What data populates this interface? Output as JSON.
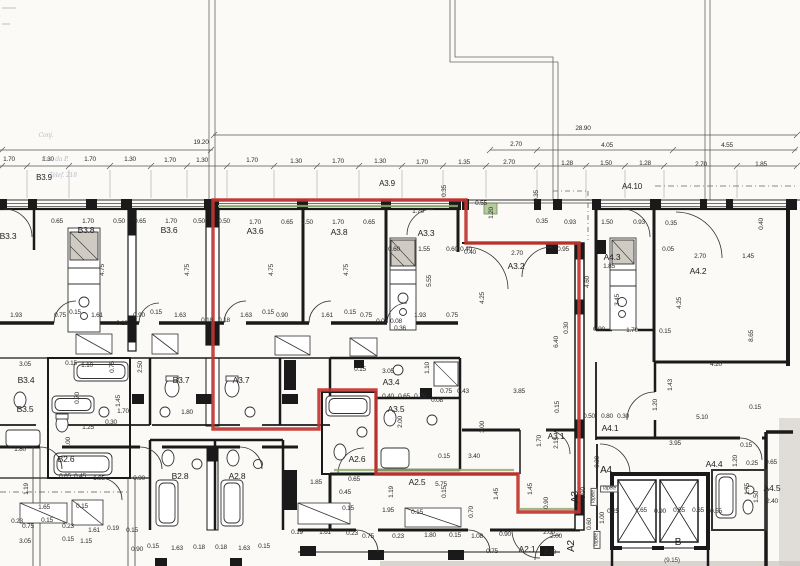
{
  "drawing": {
    "type": "apartment-floor-plan-scan",
    "highlighted_unit": "A3",
    "colors": {
      "outline_red": "#c23530",
      "outline_green": "#8fae6e",
      "wall": "#1a1a1a",
      "dim_text": "#2e2c2a",
      "paper": "#fbfaf7"
    }
  },
  "red_outline": {
    "points": "213,200 466,200 466,243 579,243 579,512 518,512 518,474 376,474 376,390 319,390 319,429 213,429"
  },
  "annotations": [
    {
      "t": "28.90",
      "x": 583,
      "y": 129
    },
    {
      "t": "19.20",
      "x": 201,
      "y": 143
    },
    {
      "t": "2.70",
      "x": 516,
      "y": 145
    },
    {
      "t": "4.05",
      "x": 607,
      "y": 146
    },
    {
      "t": "4.55",
      "x": 727,
      "y": 146
    },
    {
      "t": "1.70",
      "x": 9,
      "y": 160
    },
    {
      "t": "1.30",
      "x": 48,
      "y": 160
    },
    {
      "t": "1.70",
      "x": 90,
      "y": 160
    },
    {
      "t": "1.30",
      "x": 130,
      "y": 160
    },
    {
      "t": "1.70",
      "x": 170,
      "y": 161
    },
    {
      "t": "1.30",
      "x": 202,
      "y": 161
    },
    {
      "t": "1.70",
      "x": 252,
      "y": 161
    },
    {
      "t": "1.30",
      "x": 296,
      "y": 162
    },
    {
      "t": "1.70",
      "x": 338,
      "y": 162
    },
    {
      "t": "1.30",
      "x": 380,
      "y": 162
    },
    {
      "t": "1.70",
      "x": 422,
      "y": 163
    },
    {
      "t": "1.35",
      "x": 464,
      "y": 163
    },
    {
      "t": "2.70",
      "x": 509,
      "y": 163
    },
    {
      "t": "1.28",
      "x": 567,
      "y": 164
    },
    {
      "t": "1.50",
      "x": 606,
      "y": 164
    },
    {
      "t": "1.28",
      "x": 645,
      "y": 164
    },
    {
      "t": "2.70",
      "x": 701,
      "y": 165
    },
    {
      "t": "1.85",
      "x": 761,
      "y": 165
    },
    {
      "t": "B3.9",
      "x": 44,
      "y": 178,
      "k": "head"
    },
    {
      "t": "A3.9",
      "x": 387,
      "y": 184,
      "k": "head"
    },
    {
      "t": "A4.10",
      "x": 632,
      "y": 187,
      "k": "head"
    },
    {
      "t": "0.65",
      "x": 57,
      "y": 222
    },
    {
      "t": "1.70",
      "x": 88,
      "y": 222
    },
    {
      "t": "0.50",
      "x": 119,
      "y": 222
    },
    {
      "t": "0.65",
      "x": 140,
      "y": 222
    },
    {
      "t": "1.70",
      "x": 171,
      "y": 222
    },
    {
      "t": "0.50",
      "x": 199,
      "y": 222
    },
    {
      "t": "0.50",
      "x": 224,
      "y": 222
    },
    {
      "t": "1.70",
      "x": 255,
      "y": 223
    },
    {
      "t": "0.65",
      "x": 287,
      "y": 223
    },
    {
      "t": "0.50",
      "x": 307,
      "y": 223
    },
    {
      "t": "1.70",
      "x": 338,
      "y": 223
    },
    {
      "t": "0.65",
      "x": 369,
      "y": 223
    },
    {
      "t": "1.70",
      "x": 418,
      "y": 212
    },
    {
      "t": "0.35",
      "x": 445,
      "y": 191,
      "r": 1
    },
    {
      "t": "0.55",
      "x": 481,
      "y": 204
    },
    {
      "t": "1.20",
      "x": 492,
      "y": 213,
      "r": 1
    },
    {
      "t": "0.35",
      "x": 537,
      "y": 196,
      "r": 1
    },
    {
      "t": "0.35",
      "x": 542,
      "y": 222
    },
    {
      "t": "0.93",
      "x": 570,
      "y": 223
    },
    {
      "t": "1.50",
      "x": 607,
      "y": 223
    },
    {
      "t": "0.93",
      "x": 639,
      "y": 223
    },
    {
      "t": "0.35",
      "x": 671,
      "y": 224
    },
    {
      "t": "0.40",
      "x": 762,
      "y": 224,
      "r": 1
    },
    {
      "t": "B3.3",
      "x": 8,
      "y": 236,
      "k": "room"
    },
    {
      "t": "B3.8",
      "x": 86,
      "y": 230,
      "k": "room"
    },
    {
      "t": "B3.6",
      "x": 169,
      "y": 230,
      "k": "room"
    },
    {
      "t": "A3.6",
      "x": 255,
      "y": 231,
      "k": "room"
    },
    {
      "t": "A3.8",
      "x": 339,
      "y": 232,
      "k": "room"
    },
    {
      "t": "A3.3",
      "x": 426,
      "y": 233,
      "k": "room"
    },
    {
      "t": "A3.2",
      "x": 516,
      "y": 266,
      "k": "room"
    },
    {
      "t": "A4.3",
      "x": 612,
      "y": 257,
      "k": "room"
    },
    {
      "t": "A4.2",
      "x": 698,
      "y": 271,
      "k": "room"
    },
    {
      "t": "0.60",
      "x": 394,
      "y": 250
    },
    {
      "t": "1.55",
      "x": 424,
      "y": 250
    },
    {
      "t": "0.60",
      "x": 452,
      "y": 250
    },
    {
      "t": "0.40",
      "x": 470,
      "y": 253
    },
    {
      "t": "4.75",
      "x": 103,
      "y": 270,
      "r": 1
    },
    {
      "t": "4.75",
      "x": 188,
      "y": 270,
      "r": 1
    },
    {
      "t": "4.75",
      "x": 272,
      "y": 270,
      "r": 1
    },
    {
      "t": "4.75",
      "x": 347,
      "y": 270,
      "r": 1
    },
    {
      "t": "5.55",
      "x": 430,
      "y": 281,
      "r": 1
    },
    {
      "t": "0.05",
      "x": 668,
      "y": 250
    },
    {
      "t": "1.85",
      "x": 609,
      "y": 267
    },
    {
      "t": "2.70",
      "x": 700,
      "y": 257
    },
    {
      "t": "1.45",
      "x": 748,
      "y": 257
    },
    {
      "t": "4.60",
      "x": 588,
      "y": 282,
      "r": 1
    },
    {
      "t": "3.45",
      "x": 618,
      "y": 300,
      "r": 1
    },
    {
      "t": "4.25",
      "x": 680,
      "y": 303,
      "r": 1
    },
    {
      "t": "8.65",
      "x": 752,
      "y": 336,
      "r": 1
    },
    {
      "t": "0.40",
      "x": 466,
      "y": 250
    },
    {
      "t": "2.70",
      "x": 517,
      "y": 254
    },
    {
      "t": "0.95",
      "x": 563,
      "y": 250
    },
    {
      "t": "4.25",
      "x": 483,
      "y": 298,
      "r": 1
    },
    {
      "t": "0.30",
      "x": 567,
      "y": 328,
      "r": 1
    },
    {
      "t": "6.40",
      "x": 557,
      "y": 342,
      "r": 1
    },
    {
      "t": "0.90",
      "x": 599,
      "y": 330
    },
    {
      "t": "1.70",
      "x": 632,
      "y": 331
    },
    {
      "t": "0.15",
      "x": 665,
      "y": 332
    },
    {
      "t": "4.20",
      "x": 716,
      "y": 365
    },
    {
      "t": "1.43",
      "x": 671,
      "y": 385,
      "r": 1
    },
    {
      "t": "1.20",
      "x": 656,
      "y": 405,
      "r": 1
    },
    {
      "t": "5.10",
      "x": 702,
      "y": 418
    },
    {
      "t": "0.15",
      "x": 755,
      "y": 408
    },
    {
      "t": "1.93",
      "x": 16,
      "y": 316
    },
    {
      "t": "0.75",
      "x": 60,
      "y": 316
    },
    {
      "t": "0.15",
      "x": 75,
      "y": 313
    },
    {
      "t": "1.61",
      "x": 97,
      "y": 316
    },
    {
      "t": "0.90",
      "x": 139,
      "y": 316
    },
    {
      "t": "0.15",
      "x": 156,
      "y": 313
    },
    {
      "t": "1.63",
      "x": 180,
      "y": 316
    },
    {
      "t": "0.18",
      "x": 207,
      "y": 321
    },
    {
      "t": "0.18",
      "x": 224,
      "y": 321
    },
    {
      "t": "1.63",
      "x": 246,
      "y": 316
    },
    {
      "t": "0.15",
      "x": 268,
      "y": 313
    },
    {
      "t": "0.90",
      "x": 282,
      "y": 316
    },
    {
      "t": "1.61",
      "x": 327,
      "y": 316
    },
    {
      "t": "0.15",
      "x": 350,
      "y": 313
    },
    {
      "t": "0.75",
      "x": 366,
      "y": 316
    },
    {
      "t": "0.08",
      "x": 382,
      "y": 322
    },
    {
      "t": "0.08",
      "x": 396,
      "y": 322
    },
    {
      "t": "1.93",
      "x": 420,
      "y": 316
    },
    {
      "t": "0.75",
      "x": 452,
      "y": 316
    },
    {
      "t": "0.19",
      "x": 122,
      "y": 324
    },
    {
      "t": "0.36",
      "x": 400,
      "y": 329
    },
    {
      "t": "3.05",
      "x": 25,
      "y": 365
    },
    {
      "t": "0.15",
      "x": 71,
      "y": 364
    },
    {
      "t": "1.10",
      "x": 87,
      "y": 366
    },
    {
      "t": "0.75",
      "x": 113,
      "y": 367,
      "r": 1
    },
    {
      "t": "2.50",
      "x": 141,
      "y": 367,
      "r": 1
    },
    {
      "t": "1.10",
      "x": 428,
      "y": 368,
      "r": 1
    },
    {
      "t": "3.05",
      "x": 388,
      "y": 372
    },
    {
      "t": "0.15",
      "x": 360,
      "y": 370
    },
    {
      "t": "B3.4",
      "x": 26,
      "y": 380,
      "k": "room"
    },
    {
      "t": "B3.5",
      "x": 25,
      "y": 409,
      "k": "room"
    },
    {
      "t": "B2.6",
      "x": 66,
      "y": 459,
      "k": "room"
    },
    {
      "t": "B3.7",
      "x": 181,
      "y": 380,
      "k": "room"
    },
    {
      "t": "A3.7",
      "x": 241,
      "y": 380,
      "k": "room"
    },
    {
      "t": "A3.4",
      "x": 391,
      "y": 382,
      "k": "room"
    },
    {
      "t": "A3.5",
      "x": 396,
      "y": 409,
      "k": "room"
    },
    {
      "t": "A2.6",
      "x": 357,
      "y": 459,
      "k": "room"
    },
    {
      "t": "0.70",
      "x": 78,
      "y": 398,
      "r": 1
    },
    {
      "t": "2.00",
      "x": 69,
      "y": 443,
      "r": 1
    },
    {
      "t": "1.25",
      "x": 88,
      "y": 428
    },
    {
      "t": "1.80",
      "x": 20,
      "y": 450
    },
    {
      "t": "1.45",
      "x": 119,
      "y": 401,
      "r": 1
    },
    {
      "t": "1.70",
      "x": 123,
      "y": 412
    },
    {
      "t": "0.30",
      "x": 111,
      "y": 423
    },
    {
      "t": "1.80",
      "x": 187,
      "y": 413
    },
    {
      "t": "0.40",
      "x": 388,
      "y": 397
    },
    {
      "t": "0.65",
      "x": 404,
      "y": 397
    },
    {
      "t": "0.75",
      "x": 420,
      "y": 397
    },
    {
      "t": "0.75",
      "x": 446,
      "y": 392
    },
    {
      "t": "0.43",
      "x": 463,
      "y": 392
    },
    {
      "t": "3.85",
      "x": 519,
      "y": 392
    },
    {
      "t": "0.08",
      "x": 437,
      "y": 401
    },
    {
      "t": "2.00",
      "x": 401,
      "y": 422,
      "r": 1
    },
    {
      "t": "0.15",
      "x": 558,
      "y": 407,
      "r": 1
    },
    {
      "t": "0.15",
      "x": 444,
      "y": 457
    },
    {
      "t": "3.40",
      "x": 474,
      "y": 457
    },
    {
      "t": "3.00",
      "x": 483,
      "y": 427,
      "r": 1
    },
    {
      "t": "1.70",
      "x": 540,
      "y": 441,
      "r": 1
    },
    {
      "t": "2.15",
      "x": 557,
      "y": 443,
      "r": 1
    },
    {
      "t": "0.50",
      "x": 589,
      "y": 417
    },
    {
      "t": "0.80",
      "x": 607,
      "y": 417
    },
    {
      "t": "0.30",
      "x": 623,
      "y": 417
    },
    {
      "t": "A3.1",
      "x": 556,
      "y": 436,
      "k": "room"
    },
    {
      "t": "A4.1",
      "x": 610,
      "y": 428,
      "k": "room"
    },
    {
      "t": "A4.4",
      "x": 714,
      "y": 464,
      "k": "room"
    },
    {
      "t": "A4.5",
      "x": 772,
      "y": 488,
      "k": "room"
    },
    {
      "t": "A4",
      "x": 606,
      "y": 471,
      "k": "big"
    },
    {
      "t": "B",
      "x": 678,
      "y": 543,
      "k": "big"
    },
    {
      "t": "A3",
      "x": 576,
      "y": 497,
      "k": "big",
      "r": 1
    },
    {
      "t": "A2",
      "x": 572,
      "y": 546,
      "k": "big",
      "r": 1
    },
    {
      "t": "0.65",
      "x": 65,
      "y": 477
    },
    {
      "t": "0.45",
      "x": 80,
      "y": 477
    },
    {
      "t": "1.85",
      "x": 99,
      "y": 479
    },
    {
      "t": "0.90",
      "x": 139,
      "y": 479
    },
    {
      "t": "1.19",
      "x": 27,
      "y": 489,
      "r": 1
    },
    {
      "t": "1.65",
      "x": 44,
      "y": 508
    },
    {
      "t": "0.15",
      "x": 82,
      "y": 507
    },
    {
      "t": "0.23",
      "x": 17,
      "y": 522
    },
    {
      "t": "0.75",
      "x": 28,
      "y": 527
    },
    {
      "t": "0.15",
      "x": 47,
      "y": 521
    },
    {
      "t": "0.23",
      "x": 68,
      "y": 527
    },
    {
      "t": "1.61",
      "x": 94,
      "y": 531
    },
    {
      "t": "0.19",
      "x": 113,
      "y": 529
    },
    {
      "t": "0.15",
      "x": 132,
      "y": 531
    },
    {
      "t": "B2.8",
      "x": 180,
      "y": 476,
      "k": "room"
    },
    {
      "t": "A2.8",
      "x": 237,
      "y": 476,
      "k": "room"
    },
    {
      "t": "0.90",
      "x": 137,
      "y": 550
    },
    {
      "t": "0.15",
      "x": 153,
      "y": 547
    },
    {
      "t": "1.63",
      "x": 177,
      "y": 549
    },
    {
      "t": "0.18",
      "x": 199,
      "y": 548
    },
    {
      "t": "0.18",
      "x": 221,
      "y": 548
    },
    {
      "t": "1.63",
      "x": 244,
      "y": 549
    },
    {
      "t": "0.15",
      "x": 264,
      "y": 547
    },
    {
      "t": "3.05",
      "x": 25,
      "y": 542
    },
    {
      "t": "0.15",
      "x": 68,
      "y": 540
    },
    {
      "t": "1.15",
      "x": 86,
      "y": 542
    },
    {
      "t": "1.85",
      "x": 316,
      "y": 483
    },
    {
      "t": "0.65",
      "x": 354,
      "y": 480
    },
    {
      "t": "A2.5",
      "x": 417,
      "y": 482,
      "k": "room"
    },
    {
      "t": "5.75",
      "x": 441,
      "y": 485
    },
    {
      "t": "0.45",
      "x": 345,
      "y": 493
    },
    {
      "t": "1.19",
      "x": 392,
      "y": 492,
      "r": 1
    },
    {
      "t": "0.15",
      "x": 445,
      "y": 492,
      "r": 1
    },
    {
      "t": "1.45",
      "x": 497,
      "y": 494,
      "r": 1
    },
    {
      "t": "1.45",
      "x": 531,
      "y": 489,
      "r": 1
    },
    {
      "t": "0.90",
      "x": 547,
      "y": 503,
      "r": 1
    },
    {
      "t": "0.15",
      "x": 348,
      "y": 509
    },
    {
      "t": "1.95",
      "x": 388,
      "y": 511
    },
    {
      "t": "0.15",
      "x": 417,
      "y": 513
    },
    {
      "t": "0.70",
      "x": 472,
      "y": 512,
      "r": 1
    },
    {
      "t": "0.19",
      "x": 297,
      "y": 533
    },
    {
      "t": "1.61",
      "x": 325,
      "y": 533
    },
    {
      "t": "0.23",
      "x": 352,
      "y": 534
    },
    {
      "t": "0.75",
      "x": 368,
      "y": 537
    },
    {
      "t": "0.23",
      "x": 398,
      "y": 537
    },
    {
      "t": "1.80",
      "x": 430,
      "y": 536
    },
    {
      "t": "0.15",
      "x": 455,
      "y": 536
    },
    {
      "t": "1.08",
      "x": 477,
      "y": 537
    },
    {
      "t": "0.90",
      "x": 505,
      "y": 535
    },
    {
      "t": "2.00",
      "x": 549,
      "y": 533
    },
    {
      "t": "0.75",
      "x": 492,
      "y": 552
    },
    {
      "t": "A2.1",
      "x": 527,
      "y": 549,
      "k": "room"
    },
    {
      "t": "2.10",
      "x": 550,
      "y": 553
    },
    {
      "t": "3.95",
      "x": 675,
      "y": 444
    },
    {
      "t": "0.15",
      "x": 746,
      "y": 446
    },
    {
      "t": "1.20",
      "x": 736,
      "y": 461,
      "r": 1
    },
    {
      "t": "0.25",
      "x": 752,
      "y": 464
    },
    {
      "t": "0.65",
      "x": 771,
      "y": 463
    },
    {
      "t": "0.30",
      "x": 598,
      "y": 462,
      "r": 1
    },
    {
      "t": "0.90",
      "x": 584,
      "y": 493,
      "r": 1
    },
    {
      "t": "1.00",
      "x": 603,
      "y": 518,
      "r": 1
    },
    {
      "t": "0.60",
      "x": 590,
      "y": 524,
      "r": 1
    },
    {
      "t": "2.00",
      "x": 556,
      "y": 537
    },
    {
      "t": "0.25",
      "x": 613,
      "y": 512
    },
    {
      "t": "1.65",
      "x": 641,
      "y": 511
    },
    {
      "t": "0.90",
      "x": 660,
      "y": 512
    },
    {
      "t": "0.55",
      "x": 679,
      "y": 511
    },
    {
      "t": "0.65",
      "x": 698,
      "y": 511
    },
    {
      "t": "0.55",
      "x": 716,
      "y": 512
    },
    {
      "t": "1.50",
      "x": 757,
      "y": 497,
      "r": 1
    },
    {
      "t": "1.75",
      "x": 748,
      "y": 489,
      "r": 1
    },
    {
      "t": "2.40",
      "x": 772,
      "y": 502
    },
    {
      "t": "(9.15)",
      "x": 672,
      "y": 561,
      "k": "paren"
    },
    {
      "t": "Tapete",
      "x": 609,
      "y": 489,
      "k": "tapete"
    },
    {
      "t": "Tapete",
      "x": 594,
      "y": 497,
      "k": "tapete",
      "r": 1
    },
    {
      "t": "Tapete",
      "x": 597,
      "y": 540,
      "k": "tapete",
      "r": 1
    },
    {
      "t": "Conj.",
      "x": 46,
      "y": 136,
      "k": "faint"
    },
    {
      "t": "Esc. da P.",
      "x": 55,
      "y": 160,
      "k": "faint"
    },
    {
      "t": "Telef. 218",
      "x": 63,
      "y": 176,
      "k": "faint"
    }
  ]
}
